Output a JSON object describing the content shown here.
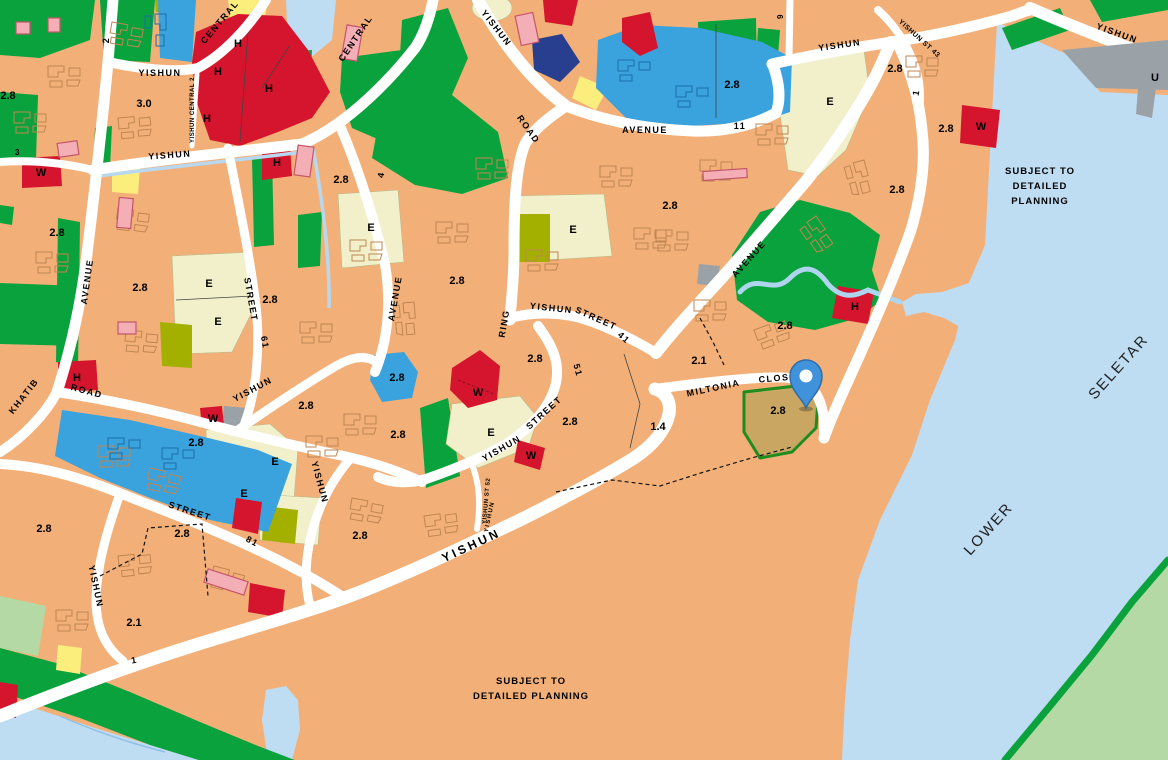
{
  "map": {
    "colors": {
      "residential_tan": "#f2b078",
      "road_white": "#ffffff",
      "water_blue": "#bedcf2",
      "park_green": "#0aa23c",
      "pale_green": "#b4d9a4",
      "institution_cream": "#f1f0cb",
      "institution_olive": "#a4b000",
      "school_blue": "#3aa2dc",
      "navy_blue": "#273f8e",
      "commercial_red": "#d5142d",
      "site_khaki": "#c9a763",
      "site_outline_green": "#1e8c1e",
      "utility_gray": "#9aa2a8",
      "pink_building": "#f3aeb6",
      "pin_blue": "#4093da"
    },
    "labels": {
      "roads": [
        {
          "text": "2",
          "x": 109,
          "y": 40,
          "rot": -90
        },
        {
          "text": "CENTRAL",
          "x": 222,
          "y": 24,
          "rot": -50
        },
        {
          "text": "YISHUN",
          "x": 160,
          "y": 76
        },
        {
          "text": "YISHUN  CENTRAL  2",
          "x": 194,
          "y": 110,
          "rot": -90,
          "size": 6,
          "ls": 0.5
        },
        {
          "text": "YISHUN",
          "x": 170,
          "y": 158,
          "rot": -4
        },
        {
          "text": "CENTRAL",
          "x": 358,
          "y": 40,
          "rot": -56
        },
        {
          "text": "4",
          "x": 384,
          "y": 175,
          "rot": -80
        },
        {
          "text": "YISHUN",
          "x": 494,
          "y": 30,
          "rot": 52
        },
        {
          "text": "ROAD",
          "x": 526,
          "y": 131,
          "rot": 55
        },
        {
          "text": "AVENUE",
          "x": 645,
          "y": 133
        },
        {
          "text": "11",
          "x": 740,
          "y": 129
        },
        {
          "text": "YISHUN",
          "x": 840,
          "y": 48,
          "rot": -8
        },
        {
          "text": "YISHUN  ST  43",
          "x": 918,
          "y": 40,
          "rot": 42,
          "size": 7,
          "ls": 0.5
        },
        {
          "text": "9",
          "x": 783,
          "y": 16,
          "rot": -90,
          "size": 8
        },
        {
          "text": "1",
          "x": 919,
          "y": 93,
          "rot": -78
        },
        {
          "text": "YISHUN",
          "x": 1116,
          "y": 36,
          "rot": 20
        },
        {
          "text": "3",
          "x": 18,
          "y": 155,
          "size": 8
        },
        {
          "text": "AVENUE",
          "x": 90,
          "y": 282,
          "rot": -82
        },
        {
          "text": "KHATIB",
          "x": 26,
          "y": 398,
          "rot": -52
        },
        {
          "text": "ROAD",
          "x": 86,
          "y": 394,
          "rot": 15
        },
        {
          "text": "STREET",
          "x": 248,
          "y": 300,
          "rot": 80
        },
        {
          "text": "61",
          "x": 262,
          "y": 343,
          "rot": 80
        },
        {
          "text": "YISHUN",
          "x": 254,
          "y": 392,
          "rot": -28
        },
        {
          "text": "AVENUE",
          "x": 398,
          "y": 299,
          "rot": -80
        },
        {
          "text": "RING",
          "x": 507,
          "y": 324,
          "rot": -80
        },
        {
          "text": "YISHUN",
          "x": 551,
          "y": 311,
          "rot": 6
        },
        {
          "text": "STREET",
          "x": 595,
          "y": 321,
          "rot": 24
        },
        {
          "text": "41",
          "x": 622,
          "y": 340,
          "rot": 42
        },
        {
          "text": "51",
          "x": 575,
          "y": 371,
          "rot": 75
        },
        {
          "text": "STREET",
          "x": 546,
          "y": 415,
          "rot": -42
        },
        {
          "text": "YISHUN",
          "x": 503,
          "y": 451,
          "rot": -30
        },
        {
          "text": "YISHUN ST 52",
          "x": 488,
          "y": 501,
          "rot": -85,
          "size": 6,
          "ls": 0.5
        },
        {
          "text": "MILTONIA",
          "x": 714,
          "y": 391,
          "rot": -12
        },
        {
          "text": "CLOSE",
          "x": 778,
          "y": 381,
          "rot": -5
        },
        {
          "text": "AVENUE",
          "x": 751,
          "y": 261,
          "rot": -48
        },
        {
          "text": "STREET",
          "x": 189,
          "y": 514,
          "rot": 18
        },
        {
          "text": "81",
          "x": 251,
          "y": 544,
          "rot": 28
        },
        {
          "text": "YISHUN",
          "x": 93,
          "y": 587,
          "rot": 78
        },
        {
          "text": "1",
          "x": 135,
          "y": 663,
          "rot": -10
        },
        {
          "text": "YISHUN",
          "x": 473,
          "y": 549,
          "rot": -25,
          "size": 12,
          "ls": 3
        },
        {
          "text": "YISHUN",
          "x": 491,
          "y": 517,
          "rot": -78,
          "size": 6
        },
        {
          "text": "YISHUN",
          "x": 317,
          "y": 483,
          "rot": 75
        }
      ],
      "zones": [
        {
          "text": "3.0",
          "x": 144,
          "y": 107
        },
        {
          "text": "2.8",
          "x": 8,
          "y": 99
        },
        {
          "text": "2.8",
          "x": 57,
          "y": 236
        },
        {
          "text": "2.8",
          "x": 140,
          "y": 291
        },
        {
          "text": "2.8",
          "x": 270,
          "y": 303
        },
        {
          "text": "2.8",
          "x": 306,
          "y": 409
        },
        {
          "text": "2.8",
          "x": 341,
          "y": 183
        },
        {
          "text": "2.8",
          "x": 457,
          "y": 284
        },
        {
          "text": "2.8",
          "x": 397,
          "y": 381
        },
        {
          "text": "2.8",
          "x": 398,
          "y": 438
        },
        {
          "text": "2.8",
          "x": 535,
          "y": 362
        },
        {
          "text": "2.8",
          "x": 570,
          "y": 425
        },
        {
          "text": "2.8",
          "x": 196,
          "y": 446
        },
        {
          "text": "2.8",
          "x": 670,
          "y": 209
        },
        {
          "text": "2.8",
          "x": 732,
          "y": 88
        },
        {
          "text": "2.8",
          "x": 785,
          "y": 329
        },
        {
          "text": "2.8",
          "x": 778,
          "y": 414
        },
        {
          "text": "2.8",
          "x": 897,
          "y": 193
        },
        {
          "text": "2.8",
          "x": 946,
          "y": 132
        },
        {
          "text": "2.8",
          "x": 895,
          "y": 72
        },
        {
          "text": "2.8",
          "x": 44,
          "y": 532
        },
        {
          "text": "2.8",
          "x": 182,
          "y": 537
        },
        {
          "text": "2.8",
          "x": 360,
          "y": 539
        },
        {
          "text": "2.1",
          "x": 699,
          "y": 364
        },
        {
          "text": "2.1",
          "x": 134,
          "y": 626
        },
        {
          "text": "1.4",
          "x": 658,
          "y": 430
        },
        {
          "text": "H",
          "x": 238,
          "y": 47
        },
        {
          "text": "H",
          "x": 218,
          "y": 75
        },
        {
          "text": "H",
          "x": 269,
          "y": 92
        },
        {
          "text": "H",
          "x": 207,
          "y": 122
        },
        {
          "text": "H",
          "x": 277,
          "y": 166
        },
        {
          "text": "H",
          "x": 77,
          "y": 381
        },
        {
          "text": "H",
          "x": 855,
          "y": 310
        },
        {
          "text": "E",
          "x": 371,
          "y": 231
        },
        {
          "text": "E",
          "x": 573,
          "y": 233
        },
        {
          "text": "E",
          "x": 830,
          "y": 105
        },
        {
          "text": "E",
          "x": 209,
          "y": 287
        },
        {
          "text": "E",
          "x": 218,
          "y": 325
        },
        {
          "text": "E",
          "x": 275,
          "y": 465
        },
        {
          "text": "E",
          "x": 244,
          "y": 497
        },
        {
          "text": "E",
          "x": 491,
          "y": 436
        },
        {
          "text": "W",
          "x": 41,
          "y": 176
        },
        {
          "text": "W",
          "x": 213,
          "y": 422
        },
        {
          "text": "W",
          "x": 478,
          "y": 396
        },
        {
          "text": "W",
          "x": 531,
          "y": 459
        },
        {
          "text": "W",
          "x": 981,
          "y": 130
        },
        {
          "text": "U",
          "x": 1155,
          "y": 81
        }
      ],
      "water": [
        {
          "text": "LOWER",
          "x": 992,
          "y": 532,
          "rot": -48
        },
        {
          "text": "SELETAR",
          "x": 1122,
          "y": 370,
          "rot": -48
        }
      ],
      "notices": [
        {
          "text": "SUBJECT TO",
          "x": 1040,
          "y": 174
        },
        {
          "text": "DETAILED",
          "x": 1040,
          "y": 189
        },
        {
          "text": "PLANNING",
          "x": 1040,
          "y": 204
        },
        {
          "text": "SUBJECT TO",
          "x": 531,
          "y": 684
        },
        {
          "text": "DETAILED PLANNING",
          "x": 531,
          "y": 699
        }
      ]
    },
    "pin": {
      "x": 806,
      "y": 408
    }
  }
}
